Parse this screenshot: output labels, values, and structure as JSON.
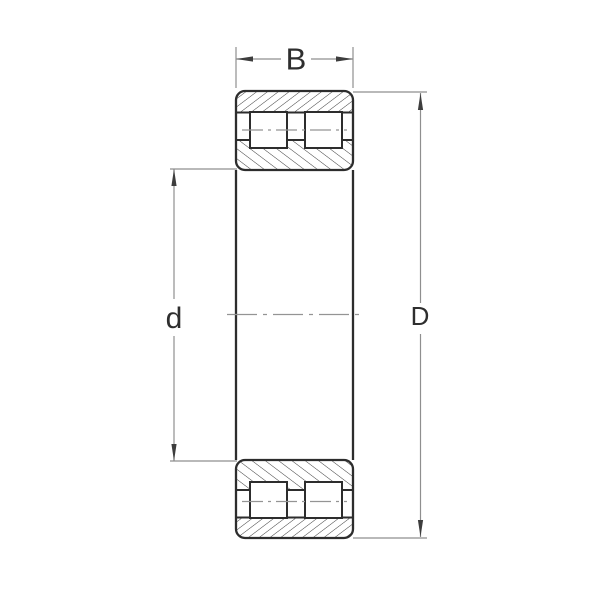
{
  "drawing": {
    "labels": {
      "width_dim": "B",
      "bore_dim": "d",
      "outer_dim": "D"
    }
  },
  "colors": {
    "background": "#ffffff",
    "outline": "#2d2d2d",
    "hatch": "#3c3c3c",
    "dimension": "#8f8f8f",
    "centerline": "#949494",
    "arrow": "#3d3d3d",
    "label_text": "#2e2e2e"
  }
}
